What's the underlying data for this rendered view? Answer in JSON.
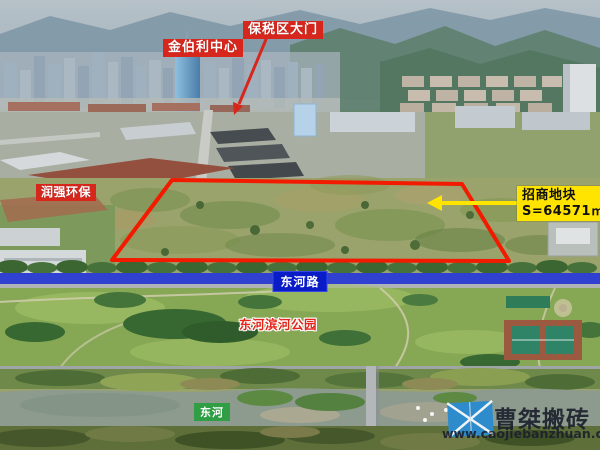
{
  "labels": {
    "jinboli": "金伯利中心",
    "baoshui_gate": "保税区大门",
    "runqiang": "润强环保",
    "plot_title": "招商地块",
    "plot_area": "S=64571㎡",
    "road": "东河路",
    "park": "东河滨河公园",
    "river": "东河"
  },
  "watermark": {
    "brand": "曹桀搬砖",
    "site": "www.caojiebanzhuan.com"
  },
  "colors": {
    "label_red": "#d7271d",
    "plot_outline": "#f21b00",
    "highlight_yellow": "#ffe400",
    "highlight_text": "#101010",
    "road_banner": "rgba(19,38,214,0.82)",
    "road_label_bg": "#0a1cc8",
    "river_label_bg": "#2f9e44",
    "park_label_text": "#e3261a",
    "watermark_blue": "#2e8ccc",
    "watermark_text": "rgba(28,33,44,0.92)"
  }
}
